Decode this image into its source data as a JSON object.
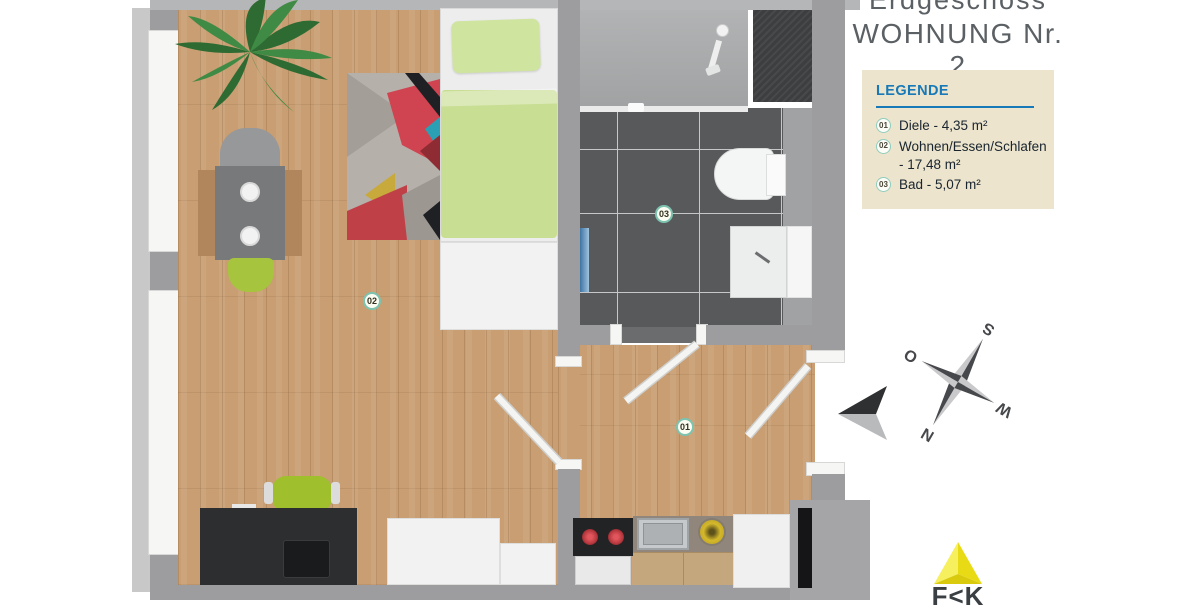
{
  "header": {
    "floor_label": "Erdgeschoss",
    "title": "WOHNUNG Nr. 2"
  },
  "legend": {
    "heading": "LEGENDE",
    "items": [
      {
        "num": "01",
        "label": "Diele - 4,35 m²"
      },
      {
        "num": "02",
        "label": "Wohnen/Essen/Schlafen - 17,48 m²"
      },
      {
        "num": "03",
        "label": "Bad - 5,07 m²"
      }
    ]
  },
  "plan": {
    "badges": [
      {
        "num": "01"
      },
      {
        "num": "02"
      },
      {
        "num": "03"
      }
    ]
  },
  "compass": {
    "n": "N",
    "e": "O",
    "s": "S",
    "w": "W"
  },
  "logo": {
    "text": "F<K"
  },
  "colors": {
    "legend_bg": "#ece4cc",
    "legend_heading_blue": "#1779b7",
    "wood_floor": "#c89e72",
    "bath_tile_dark": "#57595b",
    "accent_green": "#a3c13a",
    "duvet_green": "#c8de92",
    "badge_ring_teal": "#7cc3b0",
    "logo_yellow": "#f0e32a",
    "wall_gray": "#9d9da0"
  }
}
